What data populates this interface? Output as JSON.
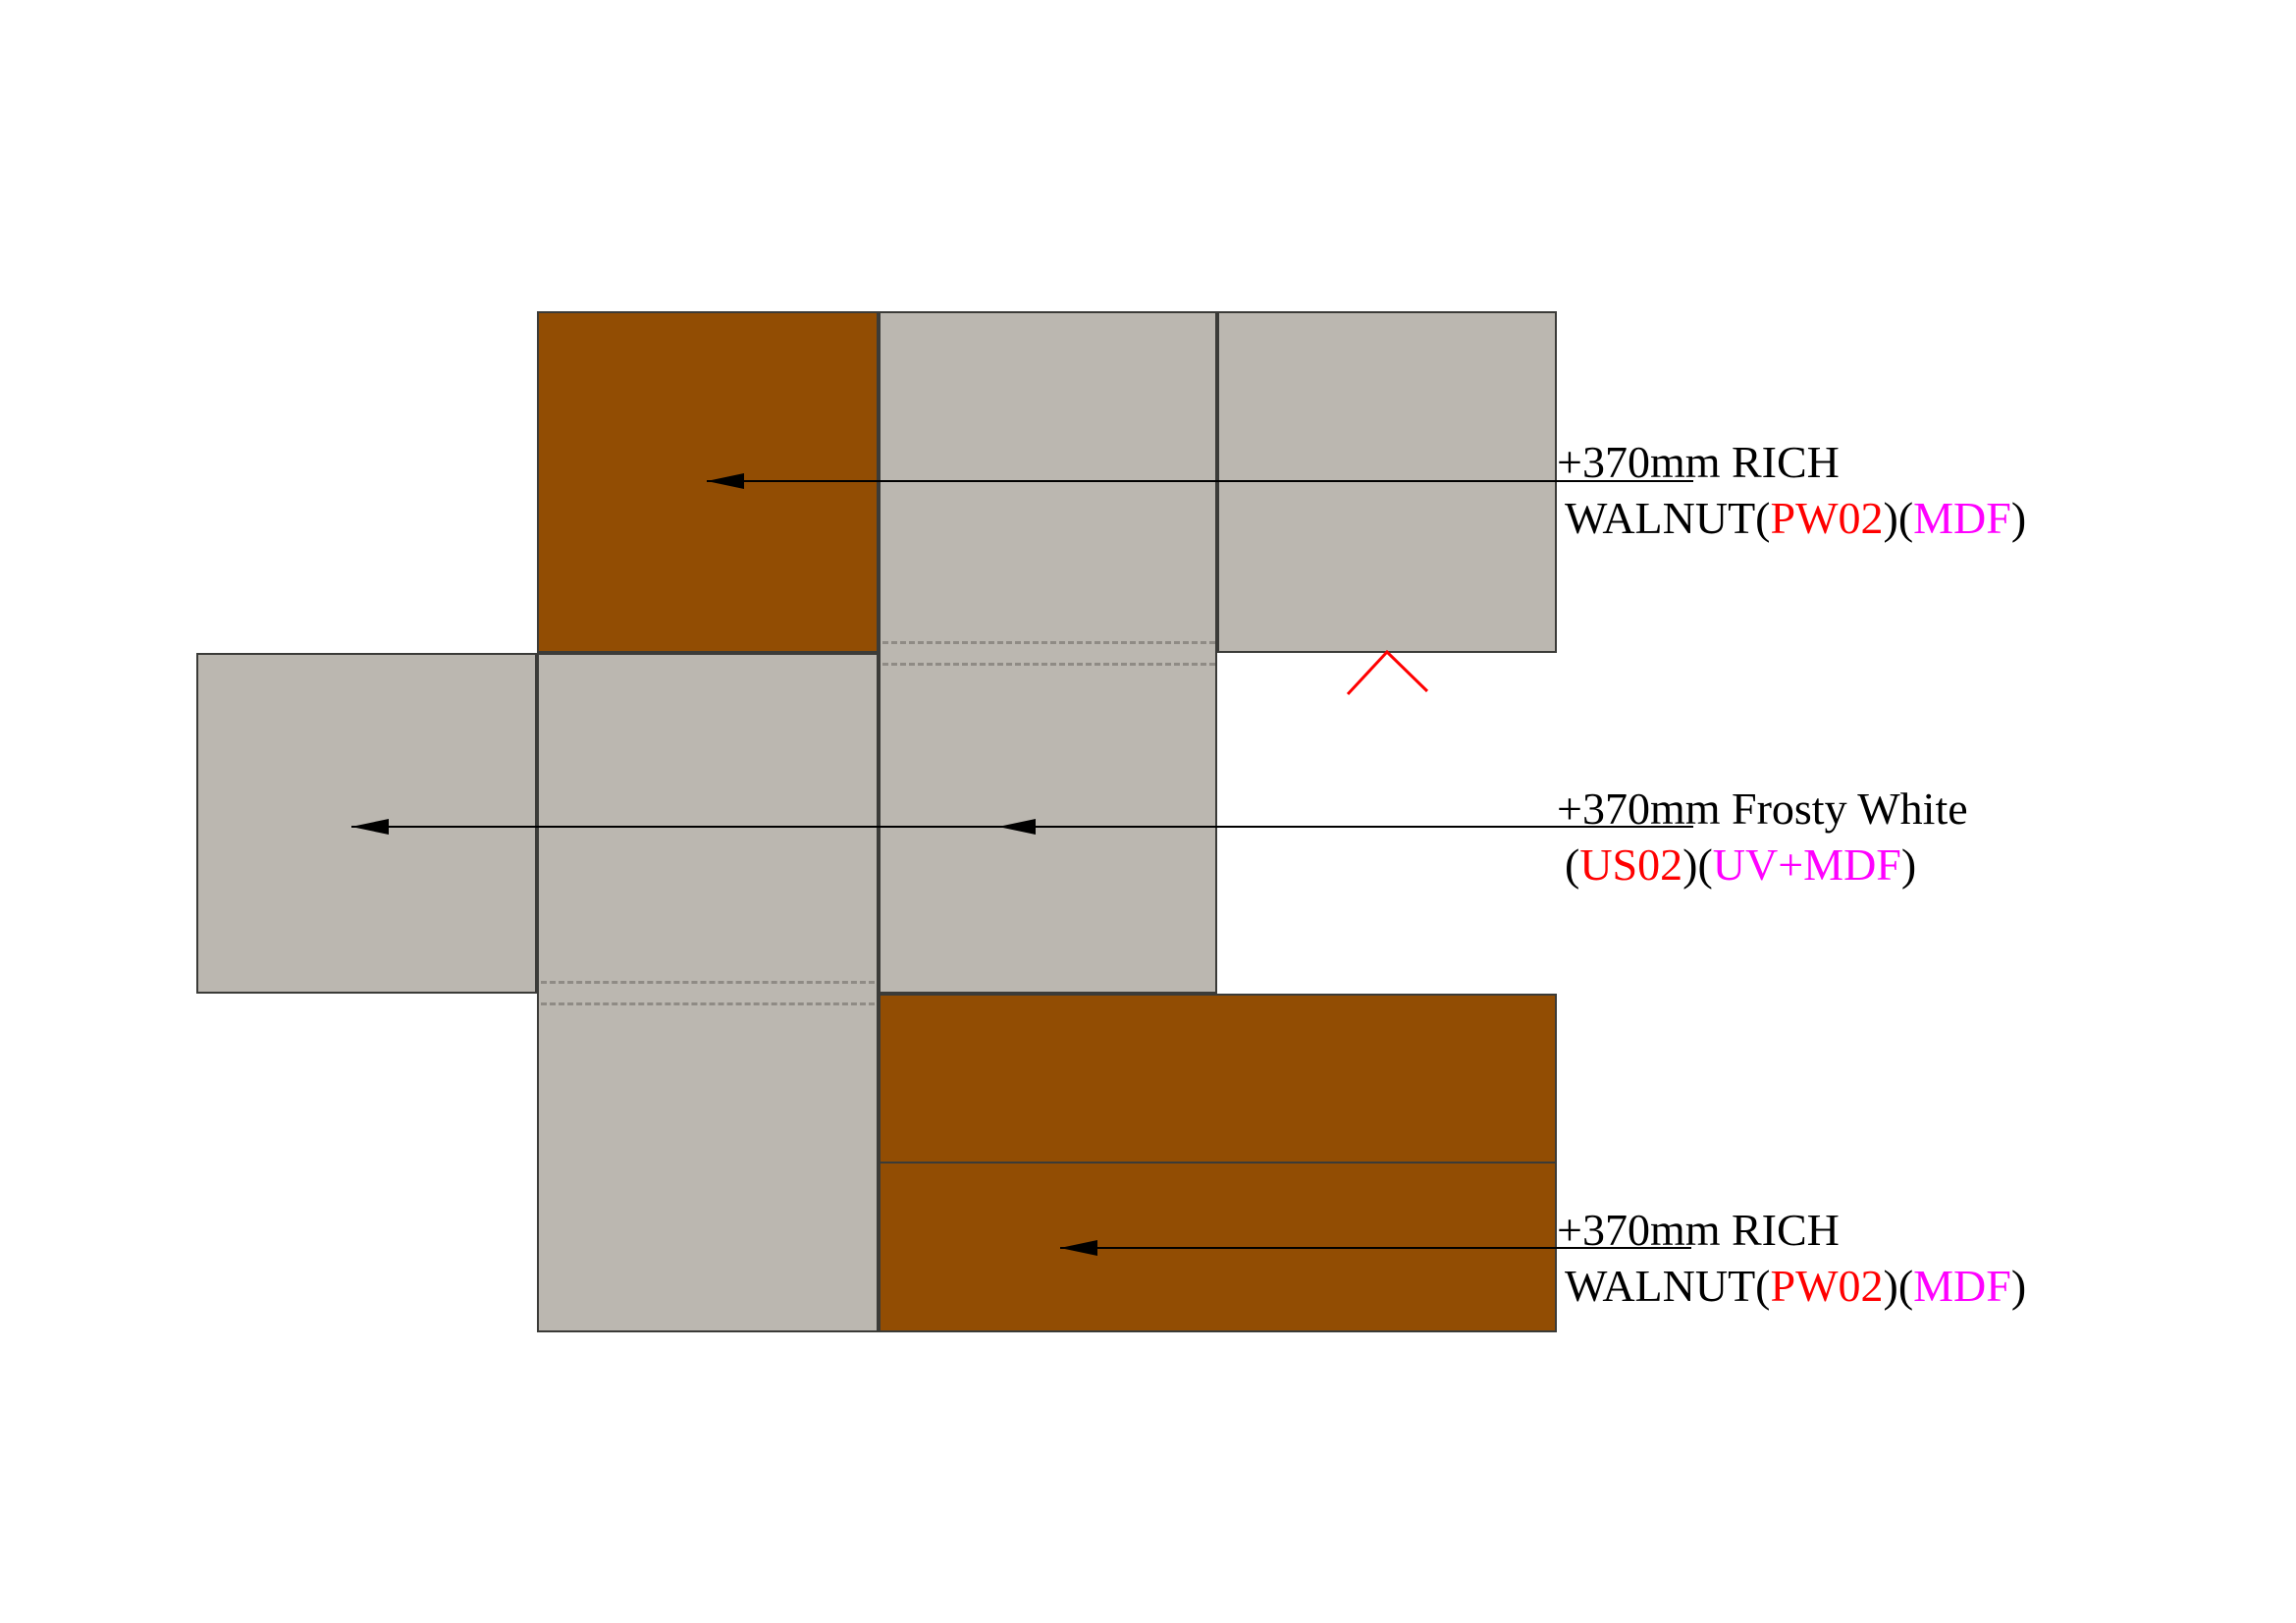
{
  "drawing": {
    "type": "cabinetry-panel-elevation-diagram",
    "colors": {
      "rich_walnut_fill": "#924d03",
      "frosty_white_fill": "#bbb7b0",
      "panel_border": "#3b3b38",
      "dashed_joint_line": "#8f8b85",
      "leader_line": "#000000",
      "code_red": "#ff0000",
      "material_magenta": "#ff00ff",
      "text_black": "#000000",
      "chevron_red": "#ff0000"
    },
    "panels": [
      {
        "name": "top-walnut-panel",
        "finish": "RICH WALNUT"
      },
      {
        "name": "upper-middle-gray-panel",
        "finish": "Frosty White"
      },
      {
        "name": "top-right-gray-panel",
        "finish": "Frosty White"
      },
      {
        "name": "left-gray-panel",
        "finish": "Frosty White"
      },
      {
        "name": "lower-middle-gray-panel",
        "finish": "Frosty White"
      },
      {
        "name": "bottom-walnut-upper-panel",
        "finish": "RICH WALNUT"
      },
      {
        "name": "bottom-walnut-lower-panel",
        "finish": "RICH WALNUT"
      }
    ],
    "callouts": [
      {
        "line1": "+370mm RICH",
        "l2a": "WALNUT(",
        "l2b": "PW02",
        "l2c": ")(",
        "l2d": "MDF",
        "l2e": ")"
      },
      {
        "line1": "+370mm Frosty White",
        "l2a": "(",
        "l2b": "US02",
        "l2c": ")(",
        "l2d": "UV+MDF",
        "l2e": ")"
      },
      {
        "line1": "+370mm RICH",
        "l2a": "WALNUT(",
        "l2b": "PW02",
        "l2c": ")(",
        "l2d": "MDF",
        "l2e": ")"
      }
    ]
  }
}
